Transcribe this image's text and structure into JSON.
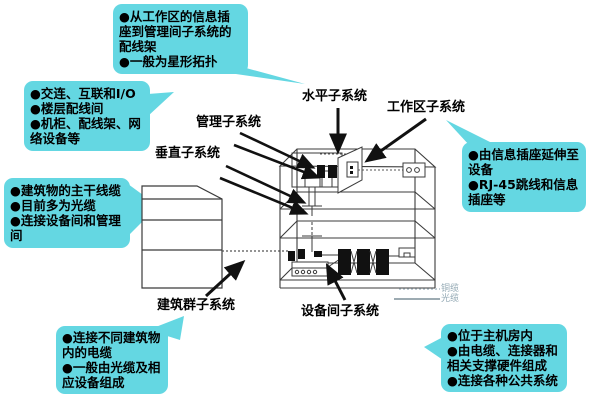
{
  "callouts": {
    "horizontal_note": {
      "lines": [
        "●从工作区的信息插座到管理间子系统的配线架",
        "●一般为星形拓扑"
      ]
    },
    "management_note": {
      "lines": [
        "●交连、互联和I/O",
        "●楼层配线间",
        "●机柜、配线架、网络设备等"
      ]
    },
    "vertical_note": {
      "lines": [
        "●建筑物的主干线缆",
        "●目前多为光缆",
        "●连接设备间和管理间"
      ]
    },
    "campus_note": {
      "lines": [
        "●连接不同建筑物内的电缆",
        "●一般由光缆及相应设备组成"
      ]
    },
    "workarea_note": {
      "lines": [
        "●由信息插座延伸至设备",
        "●RJ-45跳线和信息插座等"
      ]
    },
    "equipment_note": {
      "lines": [
        "●位于主机房内",
        "●由电缆、连接器和相关支撑硬件组成",
        "●连接各种公共系统"
      ]
    }
  },
  "labels": {
    "management": "管理子系统",
    "horizontal": "水平子系统",
    "work_area": "工作区子系统",
    "vertical": "垂直子系统",
    "campus": "建筑群子系统",
    "equipment_room": "设备间子系统"
  },
  "legend": {
    "copper": "铜缆",
    "fiber": "光缆"
  },
  "colors": {
    "callout_bg": "#64d7e2",
    "line": "#3b3b3b",
    "arrow": "#111111",
    "legend_text": "#93a9b4"
  }
}
